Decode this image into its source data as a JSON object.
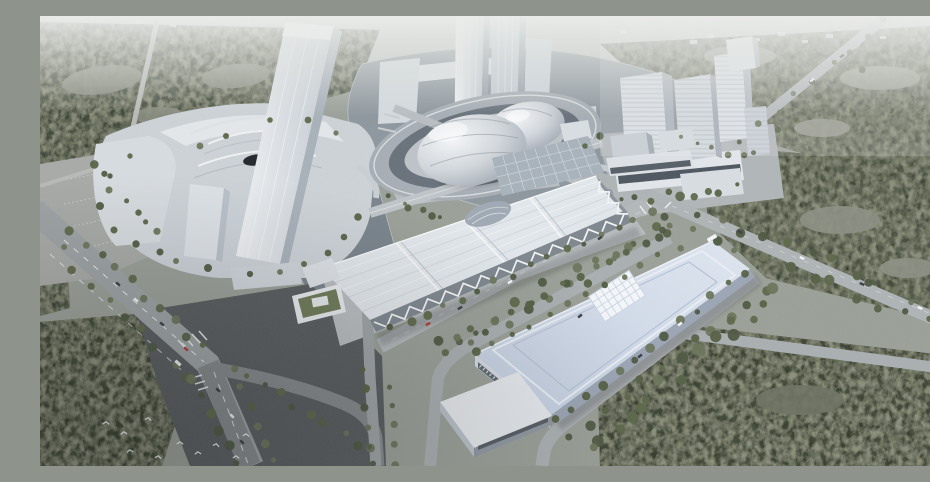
{
  "image": {
    "type": "3D architectural aerial rendering",
    "description": "Hazy aerial rendering of a civic and exhibition district: a silver double-dome theater on an oval island plaza in a lake, twin high-rise towers, a terraced white cultural complex, a cluster of curved mid-rise towers, a long white exhibition hall with zigzag roof trusses, a large convention center with a rounded pale-blue roof and central grid skylight, tree-lined boulevards, dense forests, a dark road intersection and a flock of white birds.",
    "visible_text": "none"
  },
  "palette": {
    "haze_white": "#e9ebe9",
    "ground_gray": "#9aa098",
    "forest_dark_green": "#49503f",
    "forest_gray_green": "#5a6050",
    "water_gray_blue": "#8e979e",
    "canal_dark": "#79838b",
    "road_light": "#b3b8ba",
    "asphalt_dark": "#595c5e",
    "building_white": "#e6eaee",
    "building_shadow": "#a2aab4",
    "dome_silver": "#d3d8dd",
    "convention_roof_blue": "#c9d4e4",
    "tree_green": "#5c6749",
    "car_red": "#b03a33"
  },
  "scene": {
    "elements": [
      {
        "name": "dome-theater",
        "label": "silver double-dome theater on oval island ring"
      },
      {
        "name": "twin-towers",
        "label": "twin high-rise towers at lakefront"
      },
      {
        "name": "left-cultural-complex",
        "label": "terraced podium complex with tall slab tower"
      },
      {
        "name": "right-tower-cluster",
        "label": "four curved striped mid-rise towers with podium"
      },
      {
        "name": "exhibition-hall",
        "label": "long exhibition hall with sawtooth roof and zigzag trusses"
      },
      {
        "name": "convention-center",
        "label": "convention hall with rounded pale-blue roof and grid skylight"
      },
      {
        "name": "green-roof-pavilion",
        "label": "small pavilion with green roof"
      },
      {
        "name": "lake",
        "label": "lake surrounding dome island"
      },
      {
        "name": "canal",
        "label": "canal west of exhibition hall"
      },
      {
        "name": "boulevard-avenue",
        "label": "multi-lane avenue with dashed lane lines"
      },
      {
        "name": "intersection",
        "label": "dark asphalt intersection with crosswalks"
      },
      {
        "name": "parking-lot",
        "label": "surface parking lot"
      },
      {
        "name": "forests",
        "label": "dense olive-green forest blocks"
      },
      {
        "name": "street-trees",
        "label": "rows of street trees along roads"
      },
      {
        "name": "vehicles",
        "label": "scattered cars and a bus on the roads"
      },
      {
        "name": "birds-flock",
        "label": "white birds flying over the plaza"
      }
    ]
  }
}
